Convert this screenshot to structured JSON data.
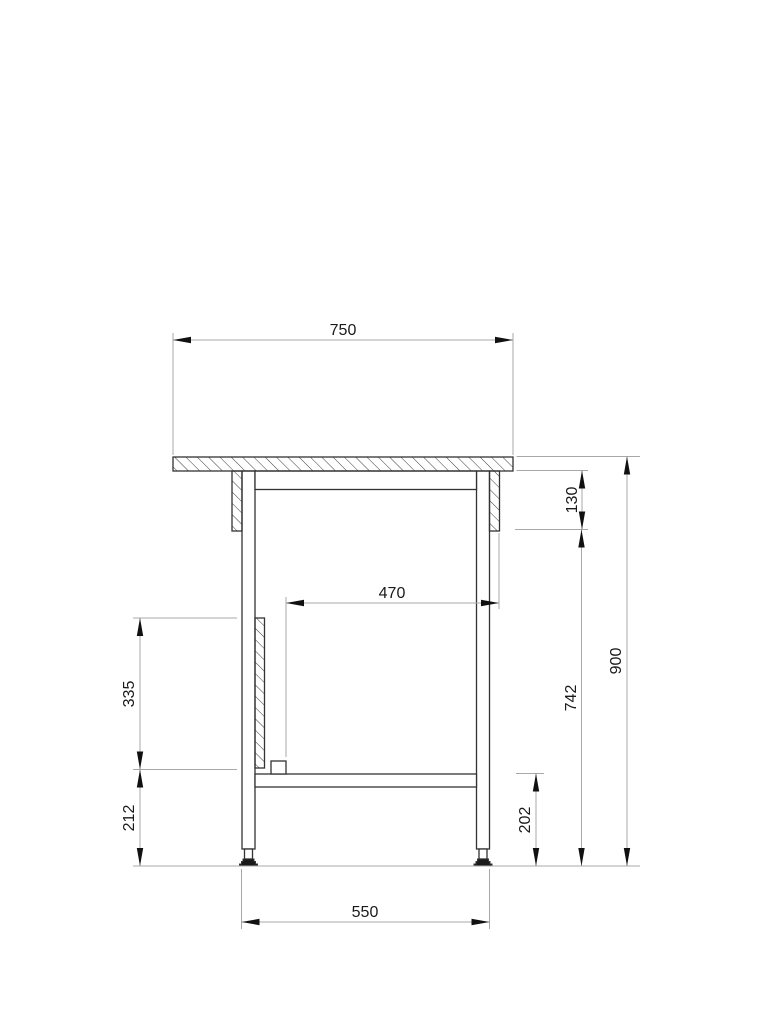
{
  "drawing": {
    "dimension_labels": {
      "tabletop_width": "750",
      "bracket_drop": "130",
      "clear_inner_width": "470",
      "slide_strip_length": "335",
      "height_under_bracket": "742",
      "overall_height": "900",
      "strip_to_floor": "212",
      "shelf_to_floor": "202",
      "leg_outer_span": "550"
    }
  },
  "colors": {
    "background": "#ffffff",
    "object_line": "#333333",
    "hatch_line": "#3c3c3c",
    "dimension_line": "#a8a8a8",
    "arrow": "#111111",
    "text": "#1a1a1a",
    "foot_fill": "#1a1a1a"
  }
}
